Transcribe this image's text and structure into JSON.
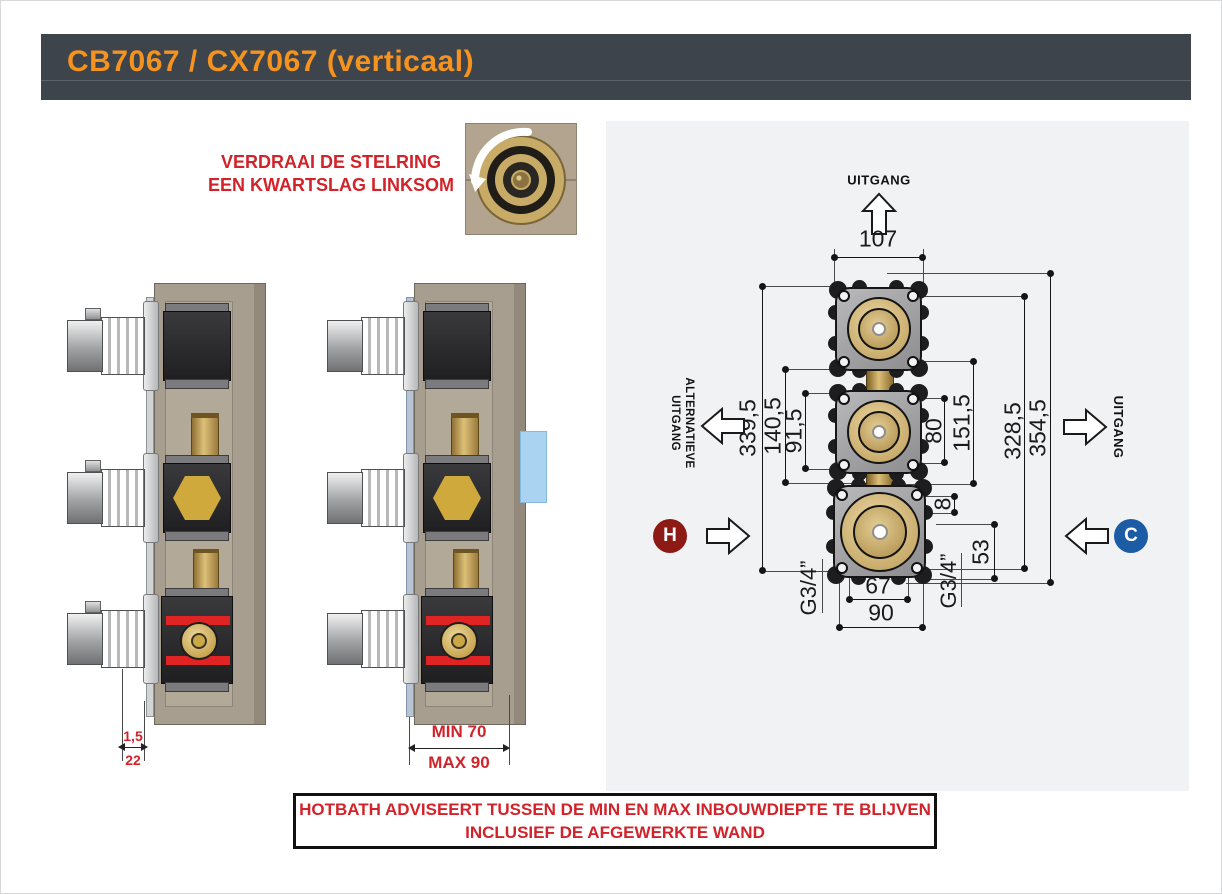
{
  "header": {
    "title": "CB7067 / CX7067 (verticaal)"
  },
  "instruction": {
    "line1": "VERDRAAI DE STELRING",
    "line2": "EEN KWARTSLAG LINKSOM"
  },
  "side_views": {
    "left": {
      "dim_plate": "1,5",
      "dim_depth": "22"
    },
    "right": {
      "dim_min": "MIN 70",
      "dim_max": "MAX 90"
    }
  },
  "diagram": {
    "labels": {
      "outlet_top": "UITGANG",
      "alt_outlet_line1": "ALTERNATIEVE",
      "alt_outlet_line2": "UITGANG",
      "outlet_right": "UITGANG",
      "hot": "H",
      "cold": "C"
    },
    "dims": {
      "w107": "107",
      "h339": "339,5",
      "h140": "140,5",
      "h91": "91,5",
      "h80": "80",
      "h151": "151,5",
      "h328": "328,5",
      "h354": "354,5",
      "d8": "8",
      "d53": "53",
      "w67": "67",
      "w90": "90",
      "g34_left": "G3/4”",
      "g34_right": "G3/4”"
    }
  },
  "warning": {
    "line1": "HOTBATH ADVISEERT TUSSEN DE MIN EN MAX INBOUWDIEPTE TE BLIJVEN",
    "line2": "INCLUSIEF DE AFGEWERKTE WAND"
  },
  "colors": {
    "header_bg": "#3d444b",
    "accent_orange": "#f6921e",
    "red": "#d2232a",
    "hot_red": "#8e1a15",
    "cold_blue": "#1b5ca4",
    "panel_bg": "#f1f2f3",
    "brass": "#c7ab66",
    "wall_tan": "#a79e8f",
    "tile_blue": "#a9d3f1"
  }
}
